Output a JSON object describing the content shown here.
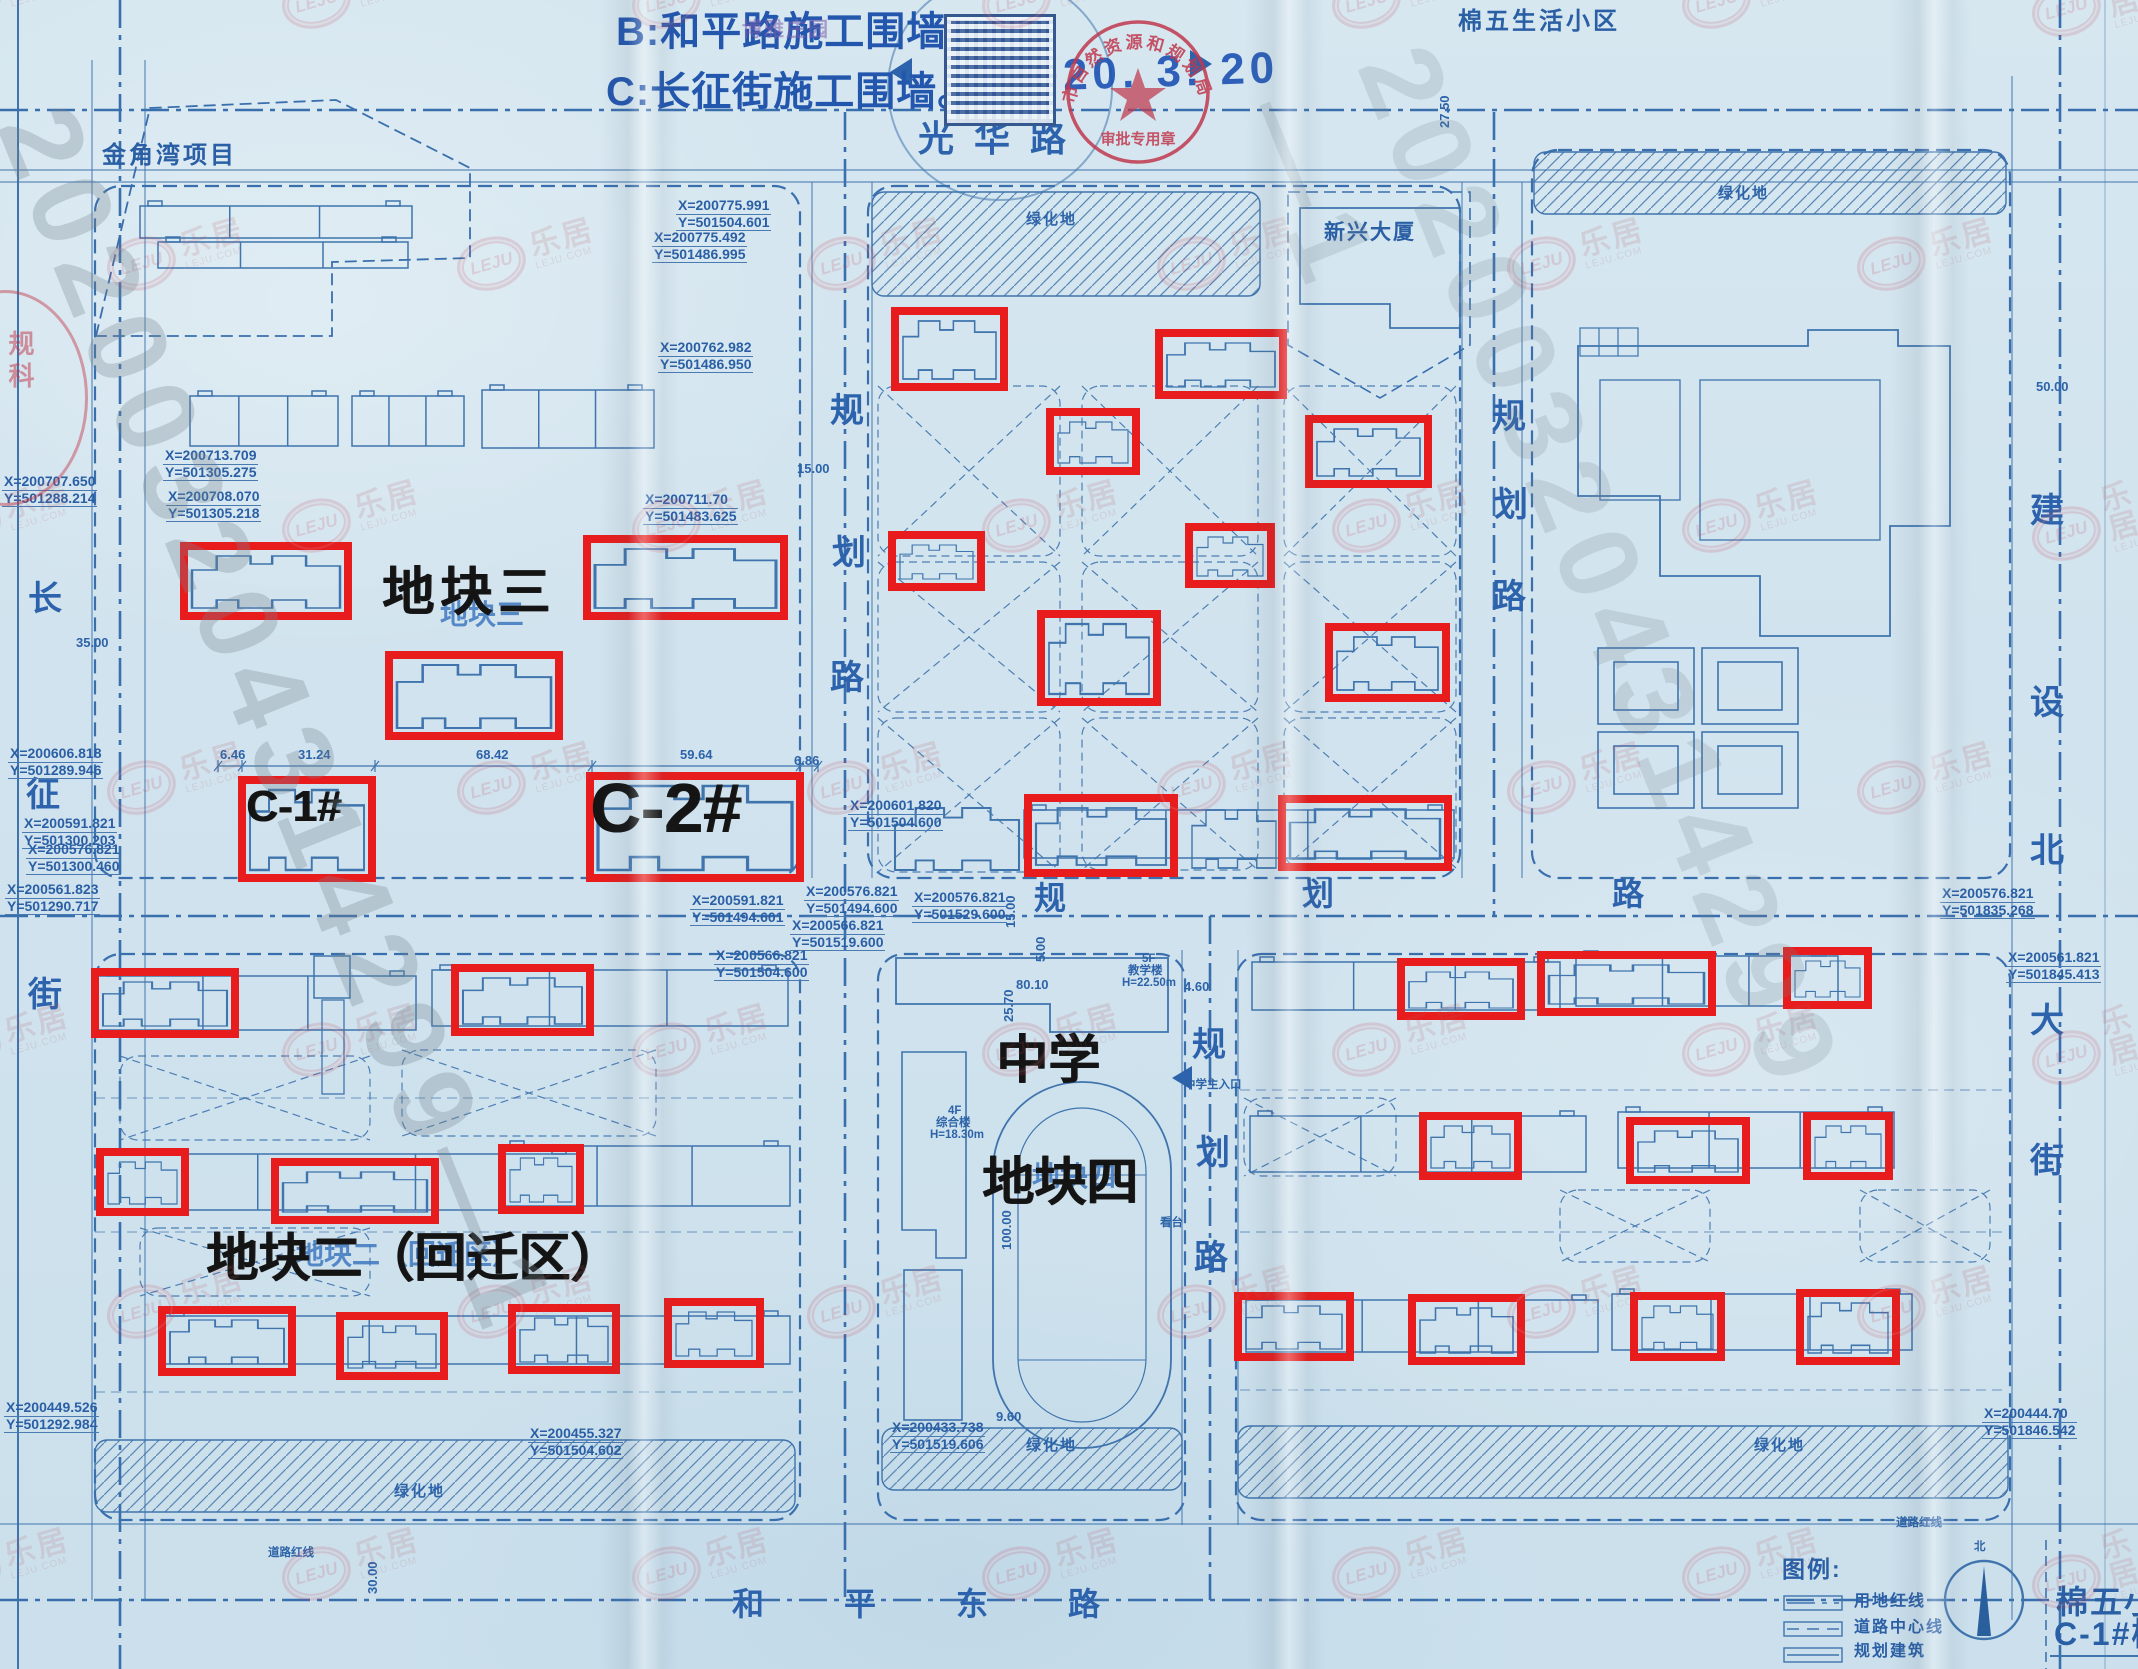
{
  "notes": {
    "b": "B:和平路施工围墙。",
    "c": "C:长征街施工围墙。",
    "date": "2020. 3. 20"
  },
  "stamp": {
    "arc": "市自然资源和规划局",
    "seal": "审批专用章",
    "side": "规科",
    "purple": "博雅庄园"
  },
  "roads": {
    "north": {
      "name": "光华路",
      "chars": [
        "光",
        "华",
        "路"
      ]
    },
    "south": {
      "name": "和平东路",
      "chars": [
        "和",
        "平",
        "东",
        "路"
      ]
    },
    "west": {
      "name": "长征街",
      "chars": [
        "长",
        "征",
        "街"
      ]
    },
    "east": {
      "name": "建设北大街",
      "chars": [
        "建",
        "设",
        "北",
        "大",
        "街"
      ]
    },
    "planned": {
      "name": "规划路",
      "chars": [
        "规",
        "划",
        "路"
      ]
    }
  },
  "areas": {
    "jinjiaowan": "金角湾项目",
    "mianwu_estate": "棉五生活小区",
    "xinxing": "新兴大厦",
    "plot3": "地块三",
    "plot2": "地块二（回迁区）",
    "plot4": "地块四",
    "school": "中学",
    "green": "绿化地",
    "c1": "C-1#",
    "c2": "C-2#"
  },
  "school": {
    "entrance": "中学主入口",
    "stand": "看台",
    "teaching": [
      "5F",
      "教学楼",
      "H=22.50m"
    ],
    "complex": [
      "4F",
      "综合楼",
      "H=18.30m"
    ]
  },
  "coords": [
    {
      "x": "X=200775.991",
      "y": "Y=501504.601"
    },
    {
      "x": "X=200775.492",
      "y": "Y=501486.995"
    },
    {
      "x": "X=200762.982",
      "y": "Y=501486.950"
    },
    {
      "x": "X=200711.70",
      "y": "Y=501483.625"
    },
    {
      "x": "X=200713.709",
      "y": "Y=501305.275"
    },
    {
      "x": "X=200708.070",
      "y": "Y=501305.218"
    },
    {
      "x": "X=200707.650",
      "y": "Y=501288.214"
    },
    {
      "x": "X=200606.818",
      "y": "Y=501289.946"
    },
    {
      "x": "X=200591.821",
      "y": "Y=501300.203"
    },
    {
      "x": "X=200576.821",
      "y": "Y=501300.460"
    },
    {
      "x": "X=200561.823",
      "y": "Y=501290.717"
    },
    {
      "x": "X=200591.821",
      "y": "Y=501494.601"
    },
    {
      "x": "X=200576.821",
      "y": "Y=501494.600"
    },
    {
      "x": "X=200566.821",
      "y": "Y=501519.600"
    },
    {
      "x": "X=200576.821",
      "y": "Y=501529.600"
    },
    {
      "x": "X=200566.821",
      "y": "Y=501504.600"
    },
    {
      "x": "X=200601.820",
      "y": "Y=501504.600"
    },
    {
      "x": "X=200576.821",
      "y": "Y=501835.268"
    },
    {
      "x": "X=200561.821",
      "y": "Y=501845.413"
    },
    {
      "x": "X=200444.70",
      "y": "Y=501846.542"
    },
    {
      "x": "X=200449.526",
      "y": "Y=501292.984"
    },
    {
      "x": "X=200455.327",
      "y": "Y=501504.602"
    },
    {
      "x": "X=200433.738",
      "y": "Y=501519.606"
    }
  ],
  "dims": {
    "d646": "6.46",
    "d3124": "31.24",
    "d6842": "68.42",
    "d5964": "59.64",
    "d686": "6.86",
    "d1500": "15.00",
    "d3500": "35.00",
    "d5000": "50.00",
    "d2750": "27.50",
    "d8010": "80.10",
    "d2570": "25.70",
    "d460": "4.60",
    "d10000": "100.00",
    "d960": "9.60",
    "d3000": "30.00",
    "d500": "5.00"
  },
  "legend": {
    "title": "图例:",
    "items": [
      "用地红线",
      "道路中心线",
      "规划建筑"
    ],
    "north": "北"
  },
  "title_block": {
    "line1": "棉五小区",
    "line2": "C-1#楼"
  },
  "road_red_line": "道路红线",
  "watermark": {
    "logo": "LEJU",
    "site": "LEJU.COM",
    "cn": "乐居",
    "serial": "202003204314299—1"
  }
}
